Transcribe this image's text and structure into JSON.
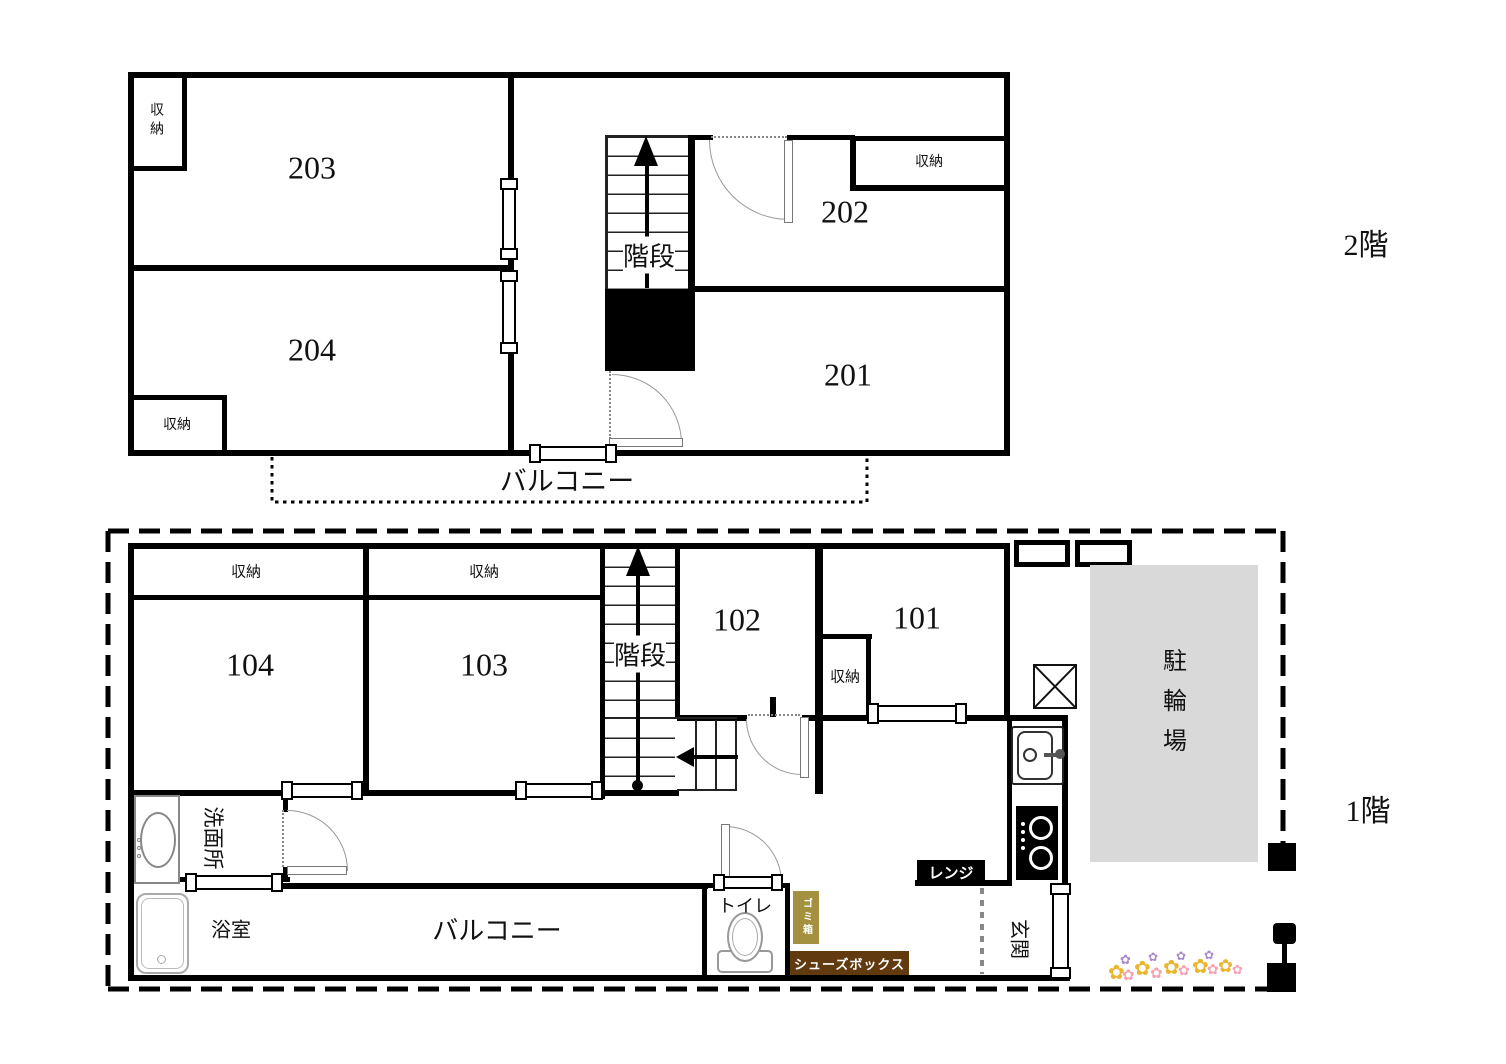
{
  "floor2": {
    "floor_label": "2階",
    "rooms": {
      "r201": "201",
      "r202": "202",
      "r203": "203",
      "r204": "204"
    },
    "closet": "収納",
    "stairs": "階段",
    "balcony": "バルコニー"
  },
  "floor1": {
    "floor_label": "1階",
    "rooms": {
      "r101": "101",
      "r102": "102",
      "r103": "103",
      "r104": "104"
    },
    "closet": "収納",
    "stairs": "階段",
    "balcony": "バルコニー",
    "washroom": "洗面所",
    "bathroom": "浴室",
    "toilet": "トイレ",
    "entrance": "玄関",
    "bike_parking": "駐輪場",
    "range": "レンジ",
    "trash_box": "ゴミ箱",
    "shoe_box": "シューズボックス"
  },
  "colors": {
    "wall": "#000000",
    "trash_box_bg": "#a3913f",
    "shoe_box_bg": "#613a10",
    "range_bg": "#000000",
    "bike_area_bg": "#d9d9d9",
    "flower_yellow": "#eab62e",
    "flower_pink": "#f2a3b4",
    "flower_purple": "#a98bc9"
  }
}
